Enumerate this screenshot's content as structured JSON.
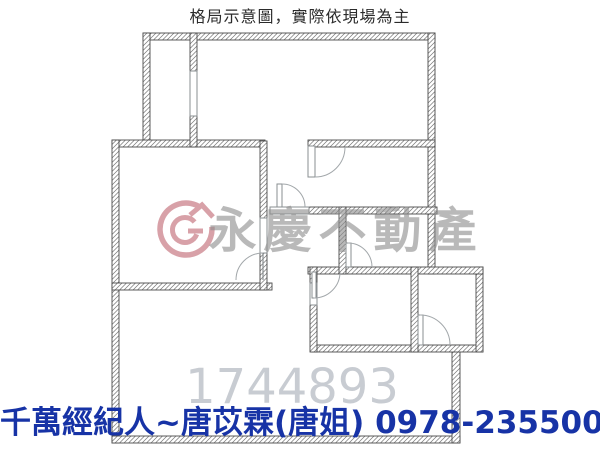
{
  "header": {
    "title": "格局示意圖，實際依現場為主"
  },
  "floorplan": {
    "watermark_brand": "永慶不動產",
    "watermark_number": "1744893"
  },
  "footer": {
    "agent_line": "千萬經紀人~唐苡霖(唐姐)  0978-235500"
  },
  "colors": {
    "footer_blue": "#1733a6",
    "title_gray": "#2b2b2b",
    "watermark_text_gray": "#8f8f8f",
    "watermark_number_gray": "#c6cad0",
    "logo_pink": "#cf8a93",
    "wall_line": "#4a4a4a",
    "hatch_line": "#767676"
  }
}
